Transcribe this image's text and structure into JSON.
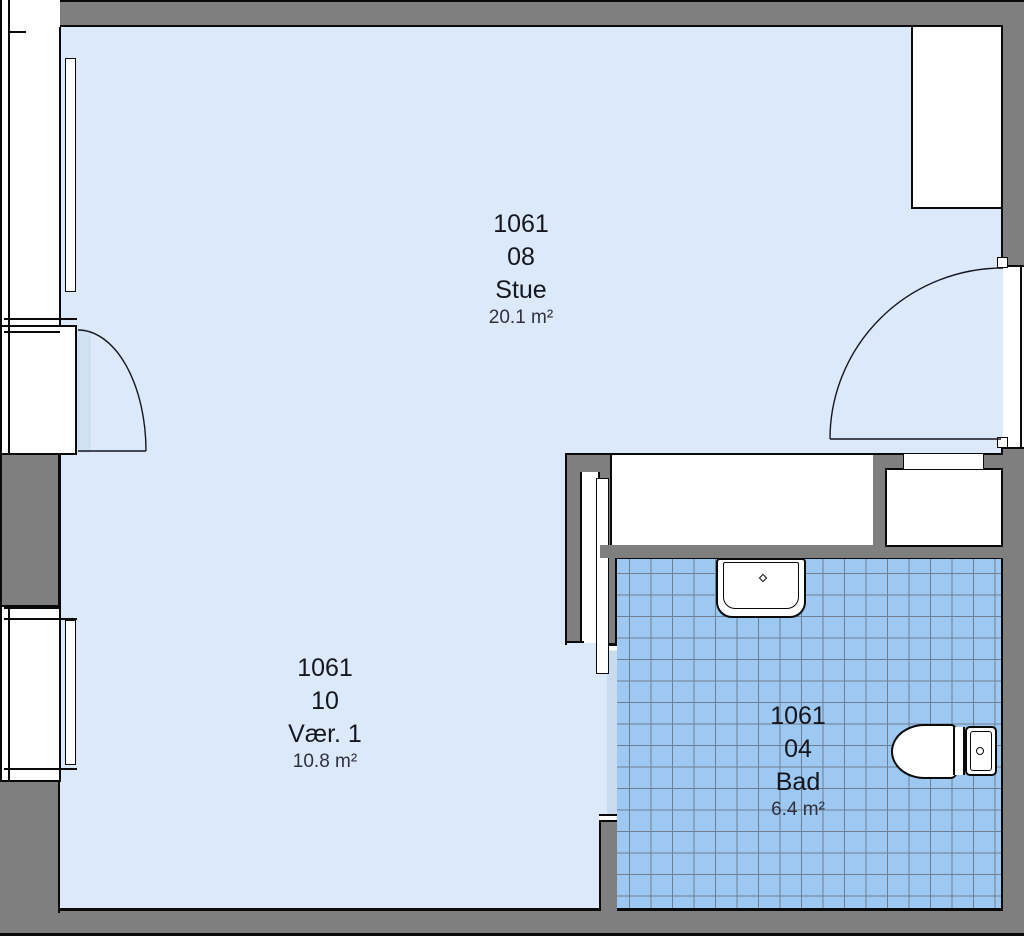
{
  "rooms": [
    {
      "number": "1061",
      "unit": "08",
      "name": "Stue",
      "area": "20.1 m²"
    },
    {
      "number": "1061",
      "unit": "10",
      "name": "Vær. 1",
      "area": "10.8 m²"
    },
    {
      "number": "1061",
      "unit": "04",
      "name": "Bad",
      "area": "6.4 m²"
    }
  ],
  "fixtures": [
    {
      "type": "sink",
      "room": "Bad"
    },
    {
      "type": "toilet",
      "room": "Bad"
    }
  ],
  "colors": {
    "floor": "#dbe9fb",
    "tile": "#9cc8f2",
    "tile-grid": "#6f7f93",
    "wall": "#7f7f7f",
    "outline": "#0a0a0a",
    "threshold": "#c9dbee",
    "label-text": "#16161e",
    "area-text": "#30303c"
  }
}
